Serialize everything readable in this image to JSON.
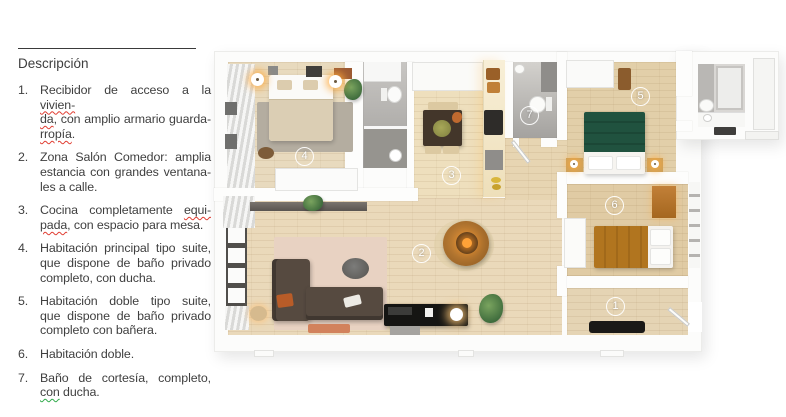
{
  "description": {
    "title": "Descripción",
    "items": [
      {
        "num": "1.",
        "lines": [
          [
            {
              "t": "Recibidor de acceso a la "
            },
            {
              "t": "vivien-",
              "m": "red"
            }
          ],
          [
            {
              "t": "da",
              "m": "red"
            },
            {
              "t": ", con amplio armario guarda-"
            }
          ],
          [
            {
              "t": "rropía",
              "m": "red"
            },
            {
              "t": "."
            }
          ]
        ]
      },
      {
        "num": "2.",
        "lines": [
          [
            {
              "t": "Zona Salón  Comedor: amplia"
            }
          ],
          [
            {
              "t": "estancia con grandes ventana-"
            }
          ],
          [
            {
              "t": "les a calle."
            }
          ]
        ]
      },
      {
        "num": "3.",
        "lines": [
          [
            {
              "t": "Cocina completamente "
            },
            {
              "t": "equi-",
              "m": "red"
            }
          ],
          [
            {
              "t": "pada",
              "m": "red"
            },
            {
              "t": ", con espacio para mesa."
            }
          ]
        ]
      },
      {
        "num": "4.",
        "lines": [
          [
            {
              "t": "Habitación principal tipo suite,"
            }
          ],
          [
            {
              "t": "que dispone de baño privado"
            }
          ],
          [
            {
              "t": "completo, con ducha."
            }
          ]
        ]
      },
      {
        "num": "5.",
        "lines": [
          [
            {
              "t": "Habitación doble tipo suite,"
            }
          ],
          [
            {
              "t": "que dispone de baño privado"
            }
          ],
          [
            {
              "t": "completo con bañera."
            }
          ]
        ]
      },
      {
        "num": "6.",
        "lines": [
          [
            {
              "t": "Habitación doble."
            }
          ]
        ]
      },
      {
        "num": "7.",
        "lines": [
          [
            {
              "t": "Baño de cortesía, completo,"
            }
          ],
          [
            {
              "t": "con",
              "m": "green"
            },
            {
              "t": " ducha."
            }
          ]
        ]
      }
    ]
  },
  "plan": {
    "room_labels": [
      "1",
      "2",
      "3",
      "4",
      "5",
      "6",
      "7"
    ],
    "colors": {
      "wood_light": "#e8dabe",
      "wall": "#fdfdfc",
      "bathroom_gray": "#a4a29f",
      "bed_green": "#20523f",
      "bed_mustard": "#b1751f",
      "sofa_brown": "#564a40",
      "fireplace_copper": "#cd8a3c",
      "glow": "#ffa94d"
    }
  }
}
